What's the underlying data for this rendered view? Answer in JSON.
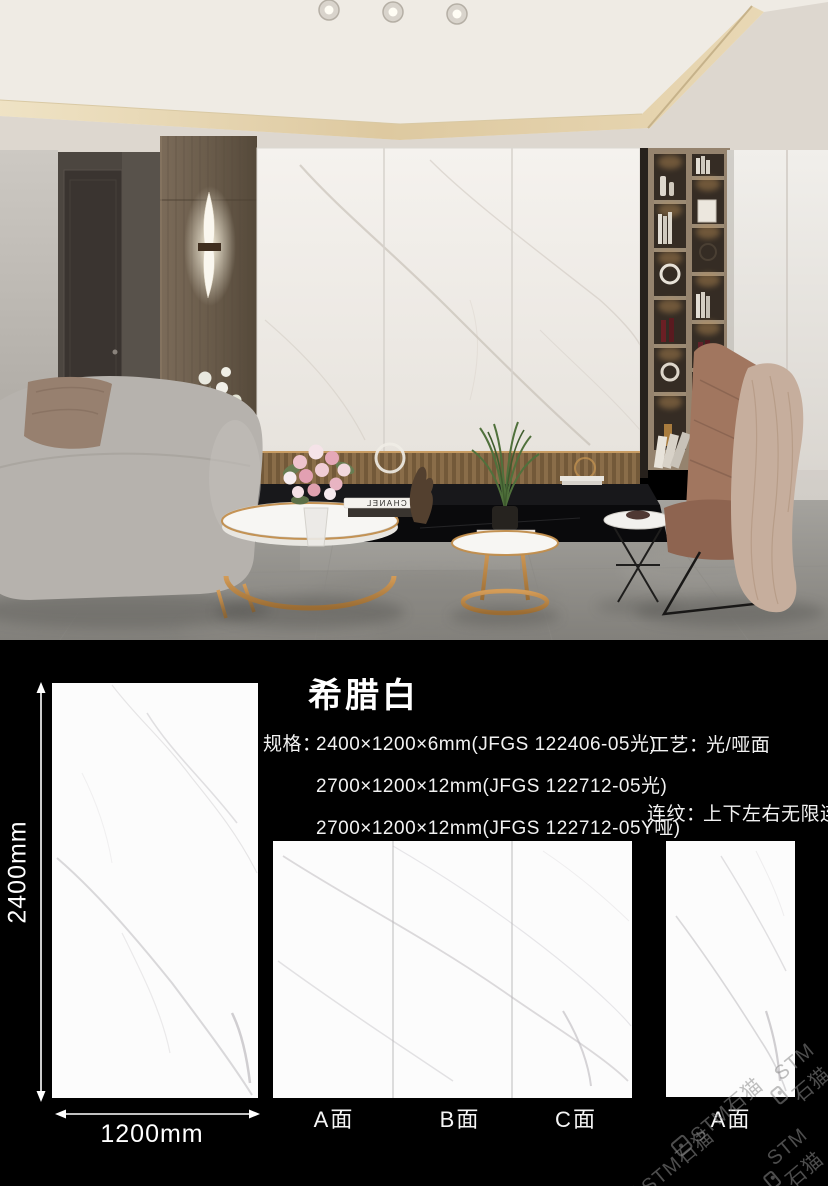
{
  "catalog": {
    "title": "希腊白",
    "spec_label": "规格：",
    "specs": [
      "2400×1200×6mm(JFGS 122406-05光)",
      "2700×1200×12mm(JFGS 122712-05光)",
      "2700×1200×12mm(JFGS 122712-05Y哑)"
    ],
    "process_label": "工艺：",
    "process_value": "光/哑面",
    "pattern_label": "连纹：",
    "pattern_value": "上下左右无限连纹",
    "dimension_height": "2400mm",
    "dimension_width": "1200mm",
    "panel_labels": [
      "A面",
      "B面",
      "C面"
    ],
    "single_panel_label": "A面",
    "watermark_text": "STM石猫"
  },
  "scene": {
    "book_spine_text": "CHANEL"
  },
  "colors": {
    "page_background": "#000000",
    "text": "#f2f2f2",
    "tile_face": "#fcfcfc",
    "tile_vein": "#c6c3c7",
    "tile_seam": "#b3b1b3",
    "watermark": "#8d8d8d",
    "brass_accent": "#b07a3e",
    "marble_wall": "#f2efe9",
    "floor_gray": "#9b9995",
    "wood_panel": "#6f6152"
  },
  "icons": {
    "stm_logo": "rounded-square-badge",
    "dimension_arrow": "double-headed-arrow",
    "downlight": "recessed-light-circle"
  }
}
